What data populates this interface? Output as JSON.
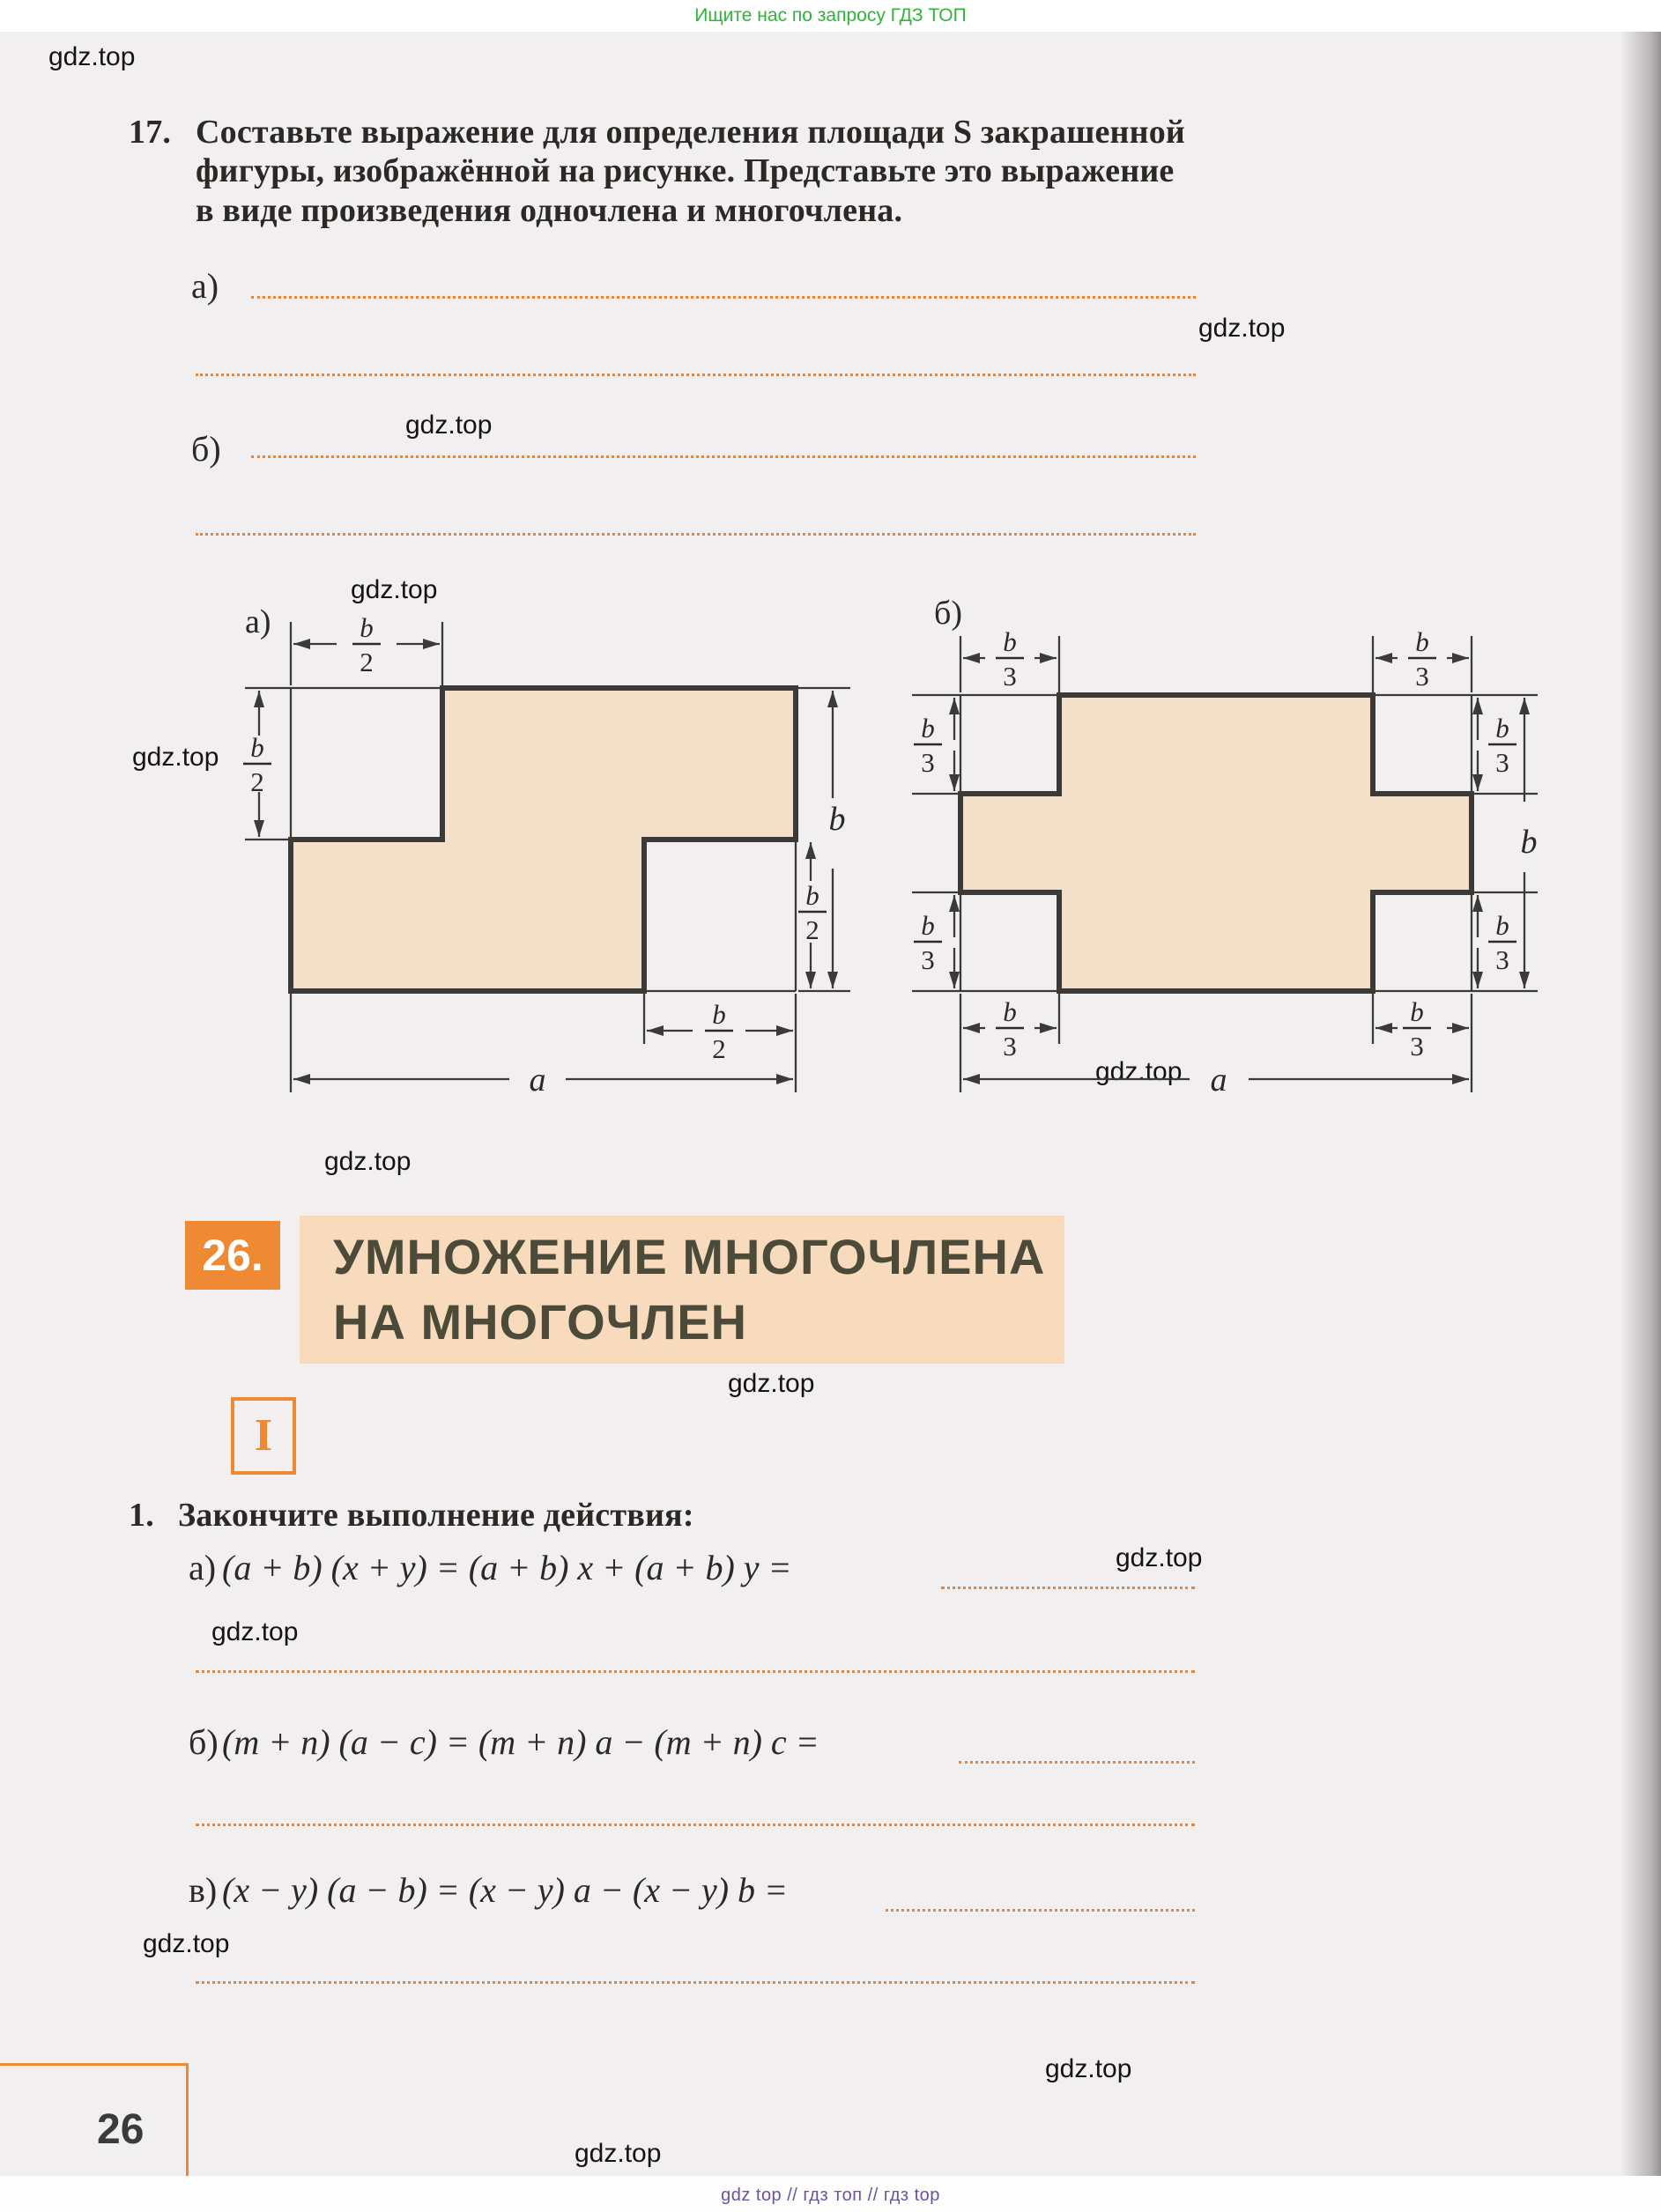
{
  "promo_banner": {
    "text": "Ищите нас по запросу ГДЗ ТОП"
  },
  "watermark": {
    "text": "gdz.top"
  },
  "problem17": {
    "number": "17.",
    "line1": "Составьте выражение для определения площади S закрашенной",
    "line2": "фигуры, изображённой на рисунке. Представьте это выражение",
    "line3": "в виде произведения одночлена и многочлена.",
    "item_a_label": "а)",
    "item_b_label": "б)"
  },
  "figures": {
    "fig_a_label": "а)",
    "fig_b_label": "б)",
    "sym_b": "b",
    "sym_a": "a",
    "den_2": "2",
    "den_3": "3"
  },
  "section": {
    "number": "26.",
    "title_line1": "УМНОЖЕНИЕ МНОГОЧЛЕНА",
    "title_line2": "НА МНОГОЧЛЕН",
    "part_label": "I"
  },
  "problem1": {
    "number": "1.",
    "title": "Закончите выполнение действия:",
    "item_a_label": "а)",
    "item_a_formula": "(a + b) (x + y) = (a + b) x + (a + b) y =",
    "item_b_label": "б)",
    "item_b_formula": "(m + n) (a − c) = (m + n) a − (m + n) c =",
    "item_v_label": "в)",
    "item_v_formula": "(x − y) (a − b) = (x − y) a − (x − y) b ="
  },
  "footer": {
    "page_number": "26",
    "footer_text": "gdz top  //  гдз топ  //  гдз top"
  }
}
